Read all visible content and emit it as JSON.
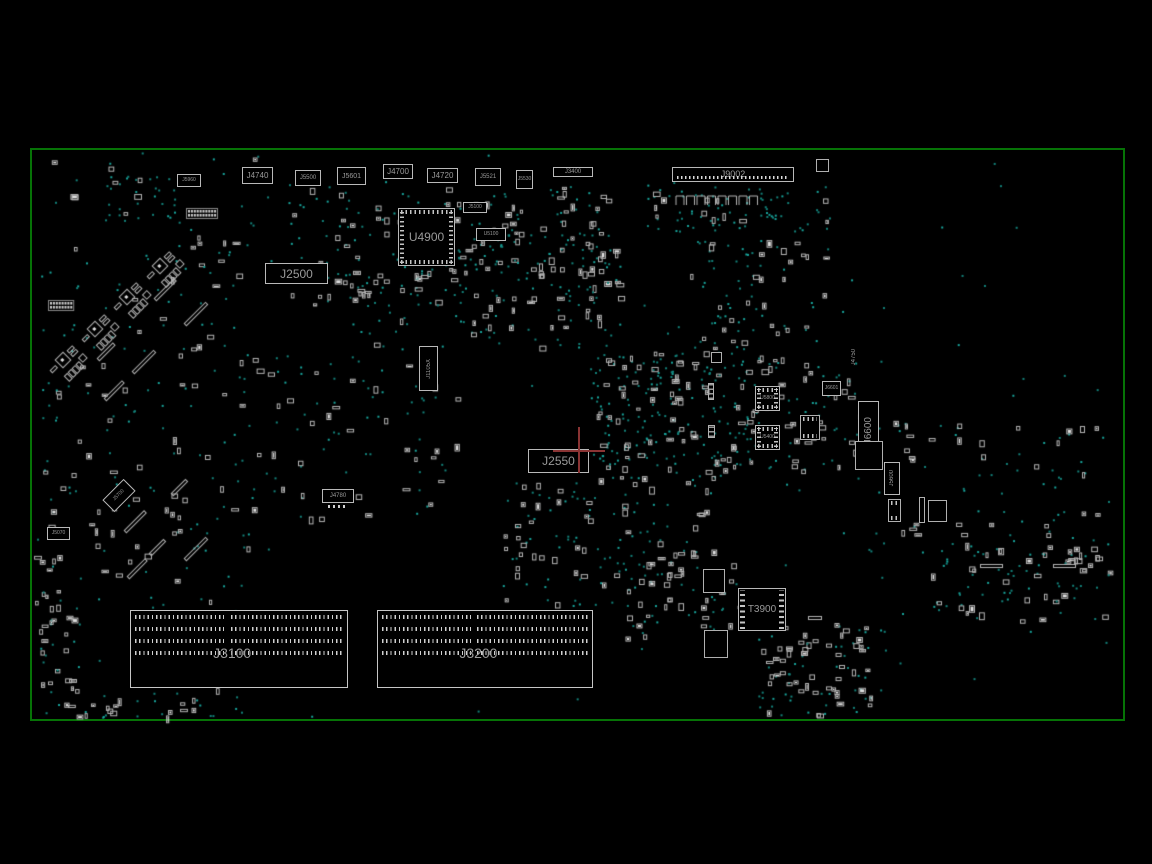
{
  "app": {
    "type": "pcb-boardview",
    "view": "top-side component layout"
  },
  "colors": {
    "background": "#000000",
    "board_outline": "#067306",
    "component_outline": "#b9b9b9",
    "label_text": "#9a9a9a",
    "via_dot": "#128079",
    "via_dot_bright": "#17a39a",
    "part_stroke": "#b5b5b5",
    "part_fill": "#e0e0e0",
    "highlight_crosshair": "#8a3434"
  },
  "board": {
    "x": 30,
    "y": 148,
    "w": 1095,
    "h": 573
  },
  "components": [
    {
      "id": "J5960",
      "x": 177,
      "y": 174,
      "w": 24,
      "h": 13,
      "fs": 5,
      "type": "box"
    },
    {
      "id": "J4740",
      "x": 242,
      "y": 167,
      "w": 31,
      "h": 17,
      "fs": 8,
      "type": "box"
    },
    {
      "id": "J5500",
      "x": 295,
      "y": 170,
      "w": 26,
      "h": 16,
      "fs": 6,
      "type": "box"
    },
    {
      "id": "J5601",
      "x": 337,
      "y": 167,
      "w": 29,
      "h": 18,
      "fs": 7,
      "type": "box"
    },
    {
      "id": "J4700",
      "x": 383,
      "y": 164,
      "w": 30,
      "h": 15,
      "fs": 8,
      "type": "box"
    },
    {
      "id": "J4720",
      "x": 427,
      "y": 168,
      "w": 31,
      "h": 15,
      "fs": 8,
      "type": "box"
    },
    {
      "id": "J5521",
      "x": 475,
      "y": 168,
      "w": 26,
      "h": 18,
      "fs": 6,
      "type": "box"
    },
    {
      "id": "J5530",
      "x": 516,
      "y": 170,
      "w": 17,
      "h": 19,
      "fs": 5,
      "type": "box"
    },
    {
      "id": "J3400",
      "x": 553,
      "y": 167,
      "w": 40,
      "h": 10,
      "fs": 6,
      "type": "box"
    },
    {
      "id": "J9002",
      "x": 672,
      "y": 167,
      "w": 122,
      "h": 15,
      "fs": 9,
      "type": "header"
    },
    {
      "id": "J5100",
      "x": 463,
      "y": 202,
      "w": 24,
      "h": 11,
      "fs": 5,
      "type": "box"
    },
    {
      "id": "U5100",
      "x": 476,
      "y": 228,
      "w": 30,
      "h": 13,
      "fs": 5,
      "type": "box"
    },
    {
      "id": "U4900",
      "x": 398,
      "y": 208,
      "w": 57,
      "h": 58,
      "fs": 12,
      "type": "chip"
    },
    {
      "id": "J2500",
      "x": 265,
      "y": 263,
      "w": 63,
      "h": 21,
      "fs": 12,
      "type": "box"
    },
    {
      "id": "J1105X",
      "x": 419,
      "y": 346,
      "w": 19,
      "h": 45,
      "fs": 6,
      "type": "vbox"
    },
    {
      "id": "J2550",
      "x": 528,
      "y": 449,
      "w": 61,
      "h": 24,
      "fs": 12,
      "type": "box"
    },
    {
      "id": "J4780",
      "x": 322,
      "y": 489,
      "w": 32,
      "h": 14,
      "fs": 6,
      "type": "box",
      "pins": "below"
    },
    {
      "id": "J5700",
      "x": 104,
      "y": 487,
      "w": 30,
      "h": 17,
      "fs": 5,
      "type": "box",
      "rot": -45
    },
    {
      "id": "J5070",
      "x": 47,
      "y": 527,
      "w": 23,
      "h": 13,
      "fs": 5,
      "type": "box"
    },
    {
      "id": "T3900",
      "x": 738,
      "y": 588,
      "w": 48,
      "h": 43,
      "fs": 10,
      "type": "transformer"
    },
    {
      "id": "J6601",
      "x": 822,
      "y": 381,
      "w": 19,
      "h": 15,
      "fs": 5,
      "type": "box"
    },
    {
      "id": "U5800",
      "x": 755,
      "y": 386,
      "w": 25,
      "h": 25,
      "fs": 5,
      "type": "chip"
    },
    {
      "id": "U5400",
      "x": 755,
      "y": 425,
      "w": 25,
      "h": 25,
      "fs": 5,
      "type": "chip"
    },
    {
      "id": "J6600",
      "x": 858,
      "y": 401,
      "w": 21,
      "h": 60,
      "fs": 10,
      "type": "vbox"
    },
    {
      "id": "J4750",
      "x": 848,
      "y": 343,
      "w": 11,
      "h": 28,
      "fs": 6,
      "type": "vtext"
    },
    {
      "id": "J5600",
      "x": 884,
      "y": 462,
      "w": 16,
      "h": 33,
      "fs": 6,
      "type": "vbox"
    }
  ],
  "slots": [
    {
      "id": "J3100",
      "x": 130,
      "y": 610,
      "w": 218,
      "h": 78
    },
    {
      "id": "J3200",
      "x": 377,
      "y": 610,
      "w": 216,
      "h": 78
    }
  ],
  "highlight": {
    "x": 578,
    "y": 450,
    "v_len": 46,
    "h_len": 52
  },
  "outline_boxes": [
    {
      "x": 855,
      "y": 441,
      "w": 28,
      "h": 29
    },
    {
      "x": 888,
      "y": 499,
      "w": 13,
      "h": 23,
      "pins": "tb"
    },
    {
      "x": 928,
      "y": 500,
      "w": 19,
      "h": 22
    },
    {
      "x": 816,
      "y": 159,
      "w": 13,
      "h": 13
    },
    {
      "x": 703,
      "y": 569,
      "w": 22,
      "h": 24
    },
    {
      "x": 704,
      "y": 630,
      "w": 24,
      "h": 28
    },
    {
      "x": 711,
      "y": 352,
      "w": 11,
      "h": 11
    },
    {
      "x": 800,
      "y": 415,
      "w": 20,
      "h": 25,
      "pins": "tb"
    },
    {
      "x": 919,
      "y": 497,
      "w": 6,
      "h": 26
    }
  ],
  "vstrips": [
    {
      "x": 708,
      "y": 383,
      "w": 6,
      "h": 17
    },
    {
      "x": 708,
      "y": 425,
      "w": 7,
      "h": 13
    }
  ],
  "texture": {
    "regions": [
      {
        "x": 285,
        "y": 185,
        "w": 330,
        "h": 120,
        "dots": 130,
        "parts": 80
      },
      {
        "x": 345,
        "y": 270,
        "w": 120,
        "h": 60,
        "dots": 25,
        "parts": 15
      },
      {
        "x": 640,
        "y": 186,
        "w": 190,
        "h": 45,
        "dots": 70,
        "parts": 12
      },
      {
        "x": 690,
        "y": 240,
        "w": 140,
        "h": 110,
        "dots": 45,
        "parts": 28
      },
      {
        "x": 590,
        "y": 350,
        "w": 175,
        "h": 130,
        "dots": 170,
        "parts": 70
      },
      {
        "x": 742,
        "y": 355,
        "w": 120,
        "h": 115,
        "dots": 45,
        "parts": 35
      },
      {
        "x": 865,
        "y": 420,
        "w": 250,
        "h": 140,
        "dots": 55,
        "parts": 35
      },
      {
        "x": 500,
        "y": 480,
        "w": 220,
        "h": 125,
        "dots": 75,
        "parts": 55
      },
      {
        "x": 620,
        "y": 560,
        "w": 120,
        "h": 90,
        "dots": 30,
        "parts": 25
      },
      {
        "x": 755,
        "y": 620,
        "w": 130,
        "h": 95,
        "dots": 45,
        "parts": 40
      },
      {
        "x": 930,
        "y": 545,
        "w": 185,
        "h": 75,
        "dots": 45,
        "parts": 32
      },
      {
        "x": 40,
        "y": 155,
        "w": 230,
        "h": 170,
        "dots": 45,
        "parts": 18
      },
      {
        "x": 105,
        "y": 175,
        "w": 70,
        "h": 45,
        "dots": 22,
        "parts": 4
      },
      {
        "x": 35,
        "y": 325,
        "w": 220,
        "h": 145,
        "dots": 40,
        "parts": 25
      },
      {
        "x": 40,
        "y": 470,
        "w": 215,
        "h": 250,
        "dots": 70,
        "parts": 60
      },
      {
        "x": 55,
        "y": 695,
        "w": 150,
        "h": 22,
        "dots": 10,
        "parts": 14
      },
      {
        "x": 33,
        "y": 555,
        "w": 25,
        "h": 120,
        "dots": 8,
        "parts": 10
      },
      {
        "x": 255,
        "y": 330,
        "w": 210,
        "h": 190,
        "dots": 55,
        "parts": 35
      },
      {
        "x": 470,
        "y": 230,
        "w": 150,
        "h": 120,
        "dots": 60,
        "parts": 40
      },
      {
        "x": 30,
        "y": 148,
        "w": 1095,
        "h": 573,
        "dots": 90,
        "parts": 0
      }
    ],
    "diag_clusters": [
      {
        "x": 160,
        "y": 266
      },
      {
        "x": 127,
        "y": 297
      },
      {
        "x": 95,
        "y": 329
      },
      {
        "x": 63,
        "y": 360
      }
    ],
    "diag_bars": [
      {
        "x": 155,
        "y": 300,
        "len": 28
      },
      {
        "x": 185,
        "y": 325,
        "len": 30
      },
      {
        "x": 98,
        "y": 360,
        "len": 22
      },
      {
        "x": 133,
        "y": 373,
        "len": 30
      },
      {
        "x": 105,
        "y": 400,
        "len": 25
      },
      {
        "x": 125,
        "y": 532,
        "len": 28
      },
      {
        "x": 150,
        "y": 555,
        "len": 20
      },
      {
        "x": 172,
        "y": 495,
        "len": 20
      },
      {
        "x": 185,
        "y": 560,
        "len": 30
      },
      {
        "x": 128,
        "y": 578,
        "len": 25
      }
    ],
    "hbars": [
      {
        "x": 980,
        "y": 564,
        "len": 22
      },
      {
        "x": 1053,
        "y": 564,
        "len": 22
      },
      {
        "x": 808,
        "y": 616,
        "len": 13
      }
    ],
    "ladders": [
      {
        "x": 188,
        "y": 210,
        "cols": 10,
        "rows": 2
      },
      {
        "x": 50,
        "y": 302,
        "cols": 8,
        "rows": 2
      }
    ],
    "comb_row": {
      "x": 676,
      "y": 196,
      "count": 8,
      "step": 10.5,
      "w": 8,
      "h": 9
    },
    "ring": {
      "cx": 812,
      "cy": 667,
      "rx": 30,
      "ry": 26,
      "count": 13
    }
  }
}
